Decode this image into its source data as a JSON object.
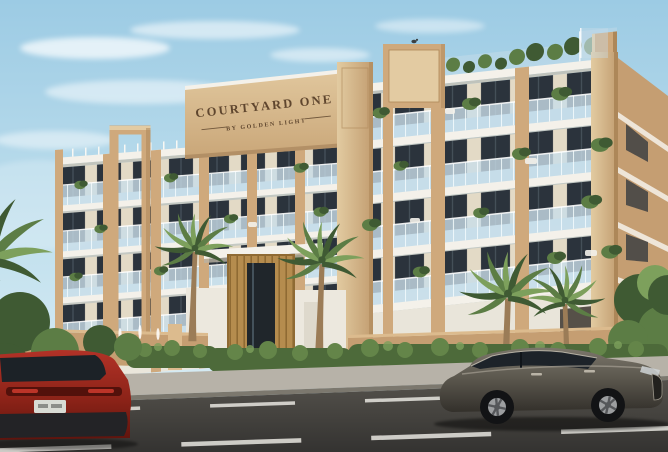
{
  "scene": {
    "sign": {
      "title": "COURTYARD ONE",
      "subtitle": "BY GOLDEN LIGHT"
    }
  },
  "palette": {
    "sky_top": "#9ccbe4",
    "sky_bottom": "#e0f0f6",
    "cloud": "#ffffff",
    "beige": "#cfa97c",
    "beige_light": "#e3cba2",
    "beige_dark": "#ad8759",
    "facade_wall": "#e3dac6",
    "slab": "#f4f1ea",
    "slab_shadow": "#c6bfb1",
    "window_dark": "#2b333c",
    "glass": "#c9dde8",
    "glass_line": "#f4fafc",
    "wood": "#b58c4e",
    "wood_dark": "#8f6a33",
    "sign_text": "#5f462e",
    "plant_dark": "#3f5a33",
    "plant_mid": "#5c7d45",
    "plant_light": "#7da05c",
    "palm_trunk": "#9b7c57",
    "hedge_dark": "#4d6a3a",
    "hedge_mid": "#648549",
    "wall": "#c59e72",
    "wall_light": "#dcbb8e",
    "sidewalk": "#b7b2a8",
    "curb": "#7c786e",
    "road_top": "#55524c",
    "road_bottom": "#343331",
    "marking": "#e8e6e0",
    "red_car": "#a72b1e",
    "gray_car": "#56524a"
  }
}
